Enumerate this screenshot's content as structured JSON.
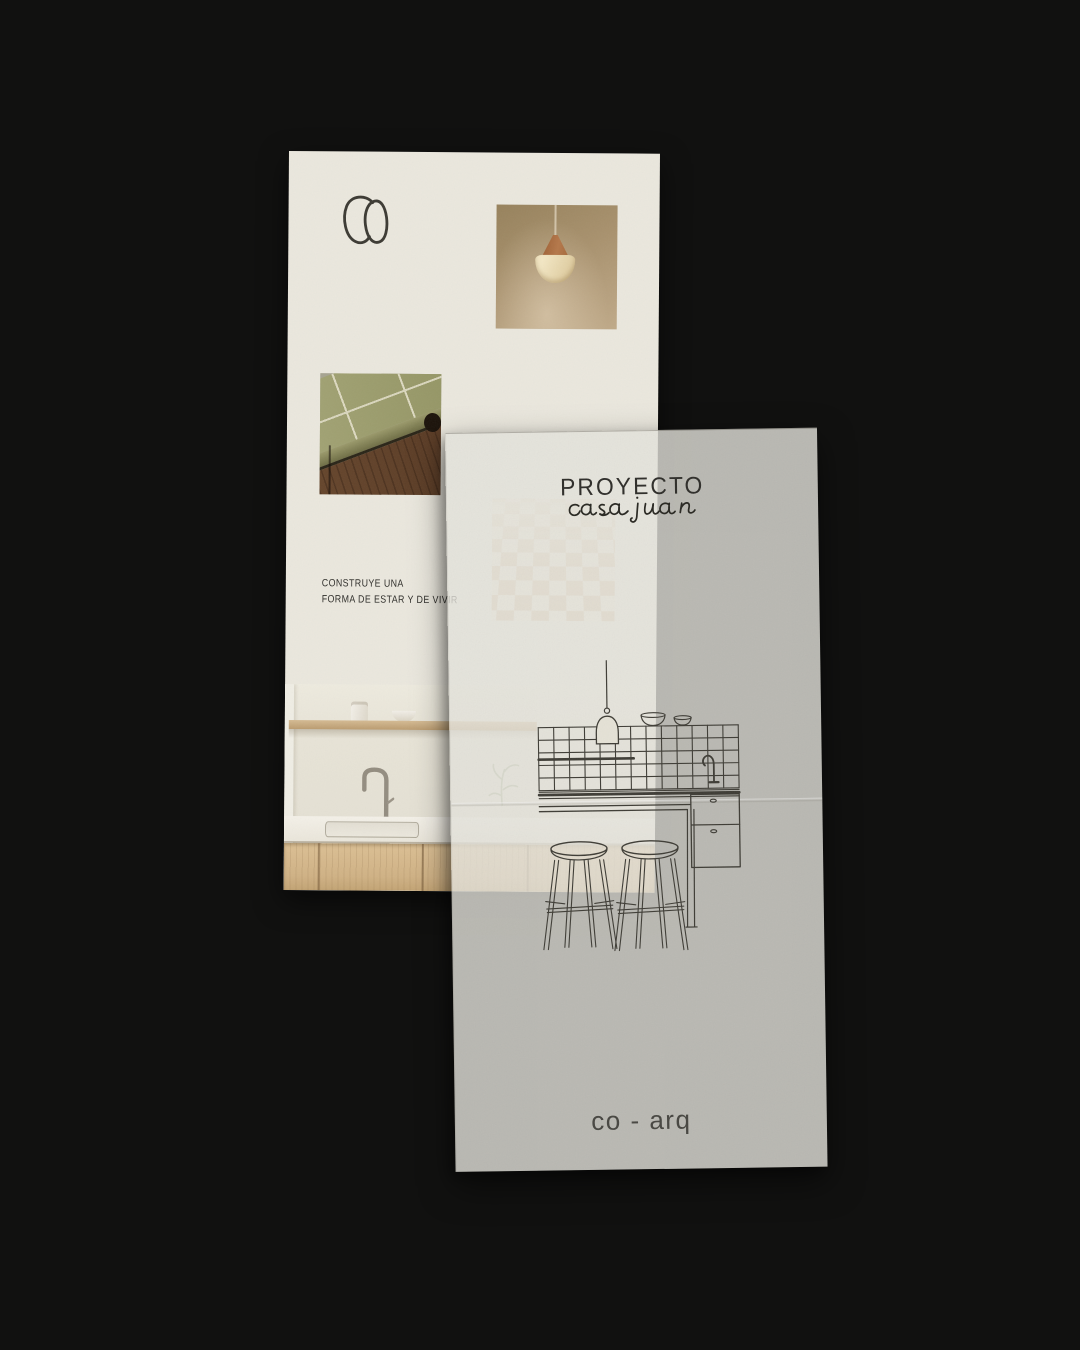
{
  "background_color": "#111110",
  "brand_card": {
    "logo_text": "CO",
    "tagline_line1": "CONSTRUYE UNA",
    "tagline_line2": "FORMA DE ESTAR Y DE VIVIR",
    "photos": {
      "pendant_lamp": "pendant lamp on warm beige wall",
      "tiled_counter": "olive tiled counter corner with walnut cabinet",
      "checkered_tiles": "faint beige checkered tiles",
      "kitchen_sink": "minimal kitchen shelf, faucet, sink and oak cabinets"
    }
  },
  "tracing_sheet": {
    "title": "PROYECTO",
    "subtitle_script": "casa juan",
    "footer_logo": "co - arq",
    "drawing": "kitchen line drawing: tiled backsplash, pendant lamp, bowls, faucet, counter with drawers and two bar stools"
  },
  "palette": {
    "background": "#111110",
    "card_paper": "#ebe8de",
    "vellum": "#e3e2db",
    "ink": "#2c2b27",
    "drawing_line": "#3c3a33",
    "tile_green": "#9b9c6c",
    "walnut": "#5c3d26",
    "oak": "#d0b285"
  }
}
